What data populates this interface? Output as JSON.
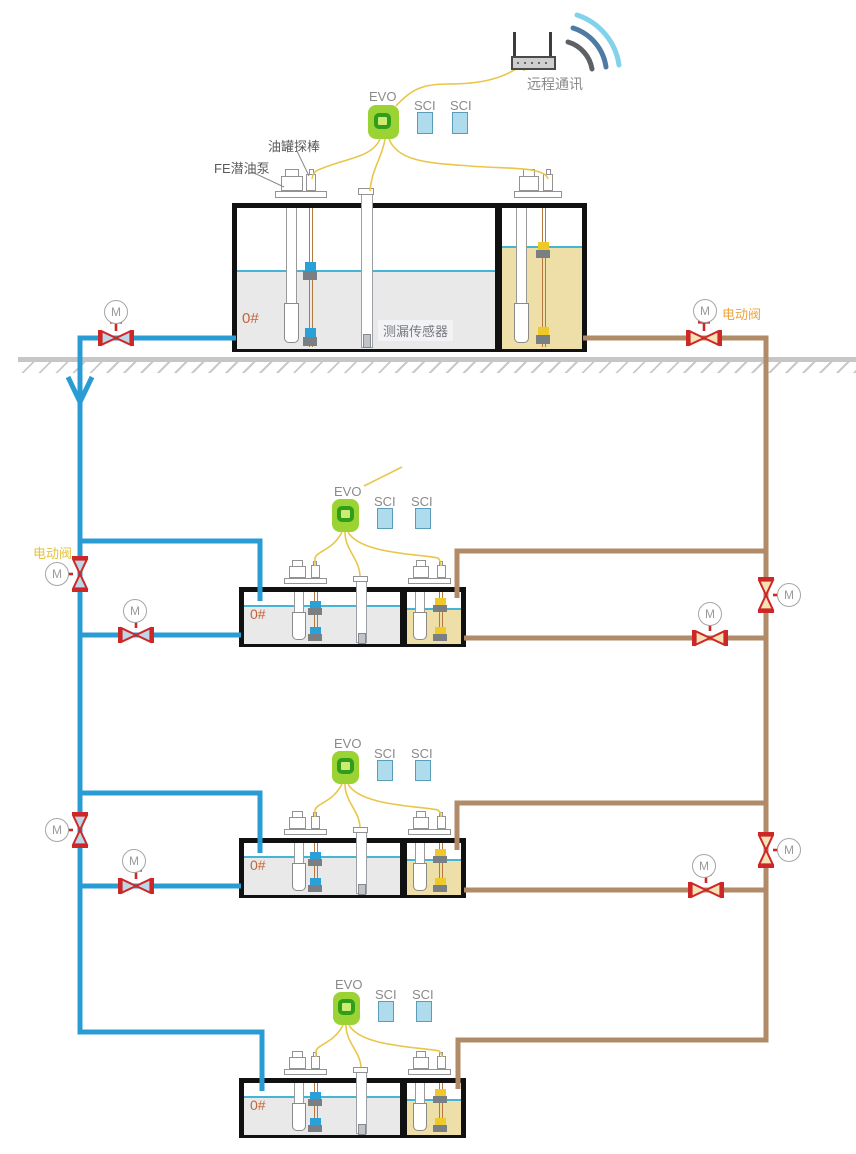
{
  "labels": {
    "remote_comm": "远程通讯",
    "evo": "EVO",
    "sci": "SCI",
    "tank_probe": "油罐探棒",
    "submersible_pump": "FE潜油泵",
    "leak_sensor": "测漏传感器",
    "fuel_grade": "0#",
    "electric_valve": "电动阀",
    "motor": "M"
  },
  "colors": {
    "diesel_pipe": "#2a9cd4",
    "gasoline_pipe": "#b18a67",
    "wire_yellow": "#e9c64a",
    "valve_red": "#ce2727",
    "valve_fill_diesel": "#bcd8e8",
    "valve_fill_gasoline": "#f6e2b4",
    "evo_green": "#9bd334",
    "evo_ring": "#2f9e1b",
    "evo_center": "#cdeb72",
    "sci_fill": "#aedcec",
    "sci_border": "#5b9cb8",
    "diesel_fill": "#e9e9e9",
    "gasoline_fill": "#eedfa8",
    "water_line": "#45b4d6",
    "float_diesel": "#29a0d8",
    "float_gasoline": "#eec928",
    "anchor_gray": "#7a7f84",
    "grade_text": "#c2643a",
    "valve_label_orange": "#efa23e",
    "valve_label_gold": "#e4c23d",
    "ground_gray": "#c6c6c6",
    "wifi_outer": "#82d2ec",
    "wifi_mid": "#4e7ba3",
    "wifi_inner": "#5d6166"
  }
}
